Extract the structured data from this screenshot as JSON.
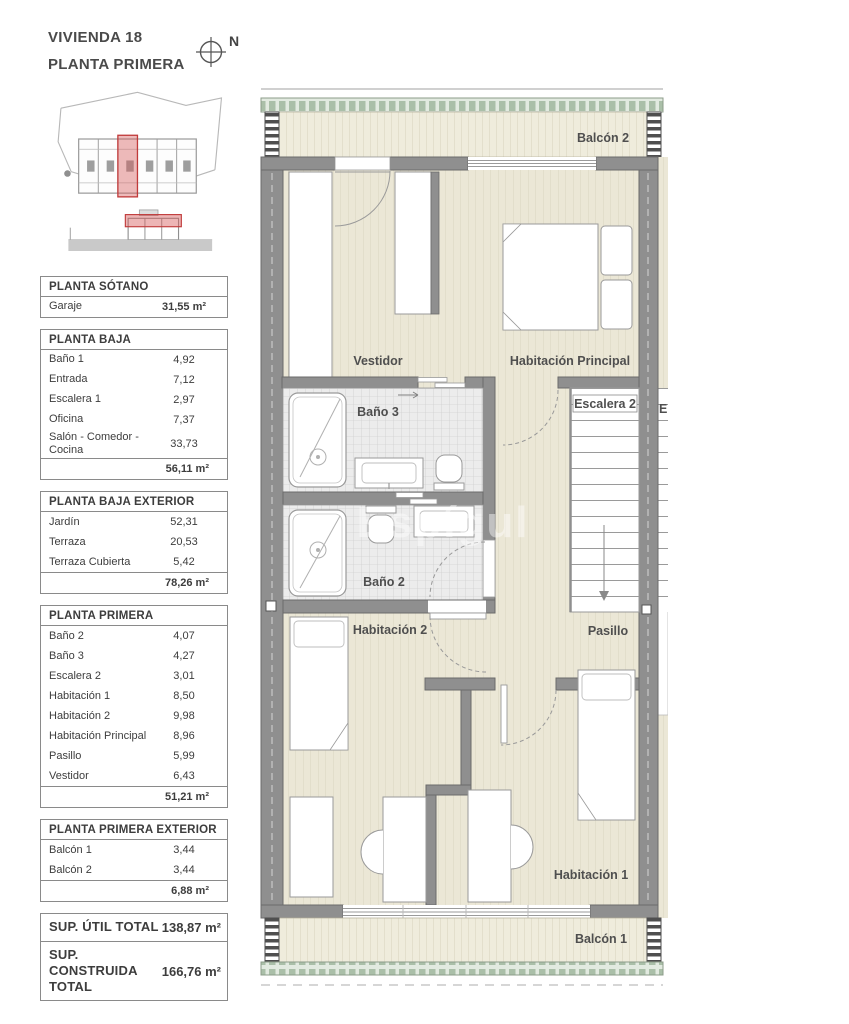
{
  "header": {
    "title_line1": "VIVIENDA 18",
    "title_line2": "PLANTA PRIMERA",
    "north_label": "N"
  },
  "tables": [
    {
      "title": "PLANTA SÓTANO",
      "rows": [
        {
          "label": "Garaje",
          "value": "31,55 m²",
          "bold": true
        }
      ],
      "total": null
    },
    {
      "title": "PLANTA BAJA",
      "rows": [
        {
          "label": "Baño 1",
          "value": "4,92"
        },
        {
          "label": "Entrada",
          "value": "7,12"
        },
        {
          "label": "Escalera 1",
          "value": "2,97"
        },
        {
          "label": "Oficina",
          "value": "7,37"
        },
        {
          "label": "Salón - Comedor - Cocina",
          "value": "33,73"
        }
      ],
      "total": "56,11 m²"
    },
    {
      "title": "PLANTA BAJA EXTERIOR",
      "rows": [
        {
          "label": "Jardín",
          "value": "52,31"
        },
        {
          "label": "Terraza",
          "value": "20,53"
        },
        {
          "label": "Terraza Cubierta",
          "value": "5,42"
        }
      ],
      "total": "78,26 m²"
    },
    {
      "title": "PLANTA PRIMERA",
      "rows": [
        {
          "label": "Baño 2",
          "value": "4,07"
        },
        {
          "label": "Baño 3",
          "value": "4,27"
        },
        {
          "label": "Escalera 2",
          "value": "3,01"
        },
        {
          "label": "Habitación 1",
          "value": "8,50"
        },
        {
          "label": "Habitación 2",
          "value": "9,98"
        },
        {
          "label": "Habitación Principal",
          "value": "8,96"
        },
        {
          "label": "Pasillo",
          "value": "5,99"
        },
        {
          "label": "Vestidor",
          "value": "6,43"
        }
      ],
      "total": "51,21 m²"
    },
    {
      "title": "PLANTA PRIMERA EXTERIOR",
      "rows": [
        {
          "label": "Balcón 1",
          "value": "3,44"
        },
        {
          "label": "Balcón 2",
          "value": "3,44"
        }
      ],
      "total": "6,88 m²"
    }
  ],
  "summary": [
    {
      "label": "SUP. ÚTIL TOTAL",
      "value": "138,87 m²"
    },
    {
      "label": "SUP. CONSTRUIDA TOTAL",
      "value": "166,76 m²"
    }
  ],
  "plan": {
    "labels": {
      "balcon2": "Balcón 2",
      "vestidor": "Vestidor",
      "hab_principal": "Habitación Principal",
      "bano3": "Baño 3",
      "escalera2": "Escalera 2",
      "bano2": "Baño 2",
      "hab2": "Habitación 2",
      "pasillo": "Pasillo",
      "hab1": "Habitación 1",
      "balcon1": "Balcón 1",
      "neighbor_cut": "E"
    },
    "watermark": "Espígul"
  },
  "colors": {
    "wall": "#8f8f8f",
    "floor": "#ebe7d6",
    "tile": "#ececec",
    "deck_band": "#aabfa8",
    "highlight_red": "#cc4444"
  }
}
